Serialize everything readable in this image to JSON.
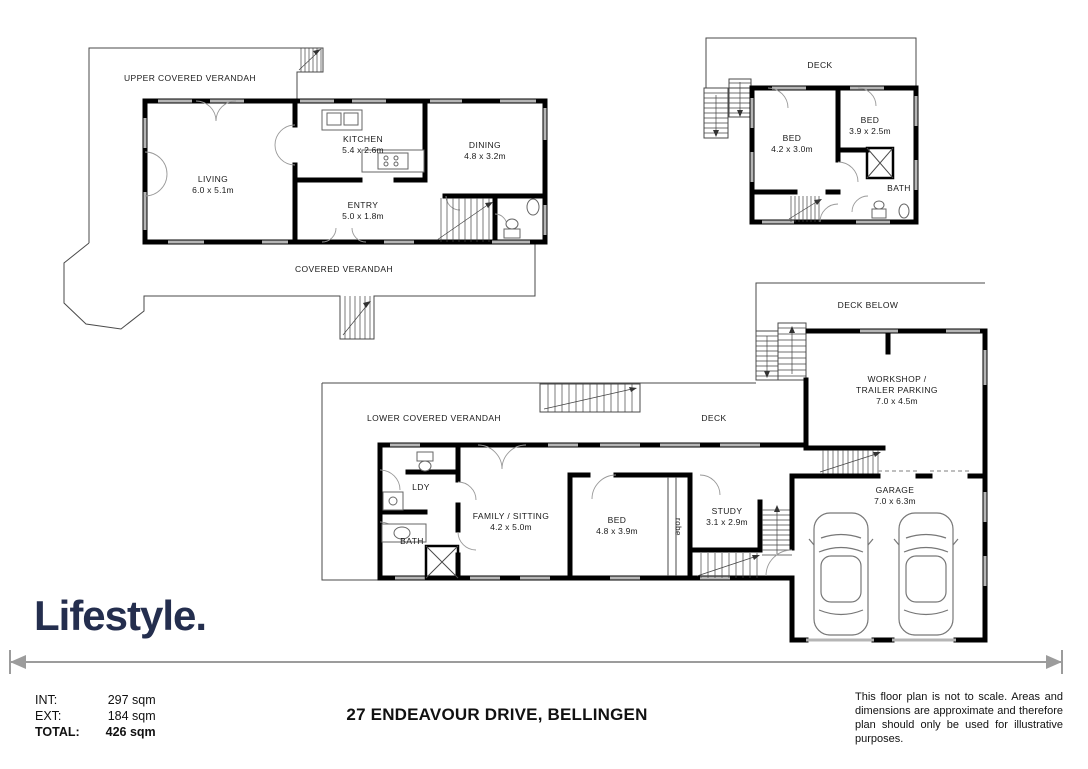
{
  "branding": {
    "logo_text": "Lifestyle.",
    "logo_color": "#242e4e"
  },
  "footer": {
    "address": "27 ENDEAVOUR DRIVE, BELLINGEN",
    "areas": {
      "int_label": "INT:",
      "int_value": "297 sqm",
      "ext_label": "EXT:",
      "ext_value": "184 sqm",
      "total_label": "TOTAL:",
      "total_value": "426 sqm"
    },
    "disclaimer": "This floor plan is not to scale. Areas and dimensions are approximate and therefore plan should only be used for illustrative purposes."
  },
  "plans": {
    "upper": {
      "verandah_top": "UPPER COVERED VERANDAH",
      "verandah_bottom": "COVERED VERANDAH",
      "living": {
        "name": "LIVING",
        "dims": "6.0 x 5.1m"
      },
      "kitchen": {
        "name": "KITCHEN",
        "dims": "5.4 x 2.6m"
      },
      "dining": {
        "name": "DINING",
        "dims": "4.8 x 3.2m"
      },
      "entry": {
        "name": "ENTRY",
        "dims": "5.0 x 1.8m"
      }
    },
    "bedroom_level": {
      "deck": "DECK",
      "bed1": {
        "name": "BED",
        "dims": "4.2 x 3.0m"
      },
      "bed2": {
        "name": "BED",
        "dims": "3.9 x 2.5m"
      },
      "bath": {
        "name": "BATH"
      }
    },
    "lower": {
      "deck_below": "DECK BELOW",
      "workshop": {
        "line1": "WORKSHOP /",
        "line2": "TRAILER PARKING",
        "dims": "7.0 x 4.5m"
      },
      "verandah": "LOWER COVERED VERANDAH",
      "deck": "DECK",
      "ldy": {
        "name": "LDY"
      },
      "bath": {
        "name": "BATH"
      },
      "family": {
        "name": "FAMILY / SITTING",
        "dims": "4.2 x 5.0m"
      },
      "bed": {
        "name": "BED",
        "dims": "4.8 x 3.9m"
      },
      "robe": {
        "name": "robe"
      },
      "study": {
        "name": "STUDY",
        "dims": "3.1 x 2.9m"
      },
      "garage": {
        "name": "GARAGE",
        "dims": "7.0 x 6.3m"
      }
    }
  }
}
